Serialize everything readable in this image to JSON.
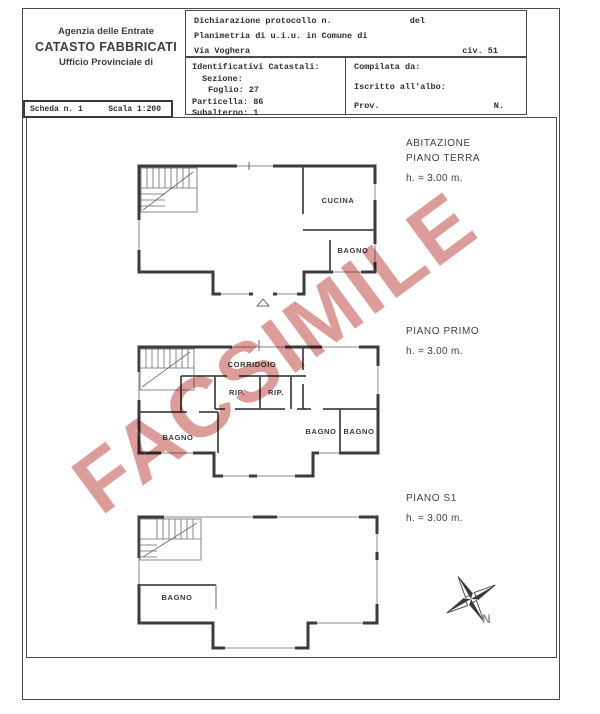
{
  "header": {
    "agency": {
      "line1": "Agenzia delle Entrate",
      "line2": "CATASTO FABBRICATI",
      "line3": "Ufficio Provinciale di"
    },
    "scheda": {
      "left": "Scheda n. 1",
      "right": "Scala 1:200"
    },
    "declaration": {
      "protocol": "Dichiarazione protocollo n.",
      "del": "del",
      "planimetria": "Planimetria di u.i.u. in Comune di",
      "street": "Via Voghera",
      "civic": "civ. 51"
    },
    "catastali": {
      "title": "Identificativi Catastali:",
      "sezione": "Sezione:",
      "foglio": "Foglio: 27",
      "particella": "Particella: 86",
      "subalterno": "Subalterno: 1"
    },
    "compilata": {
      "line1": "Compilata da:",
      "line2": "Iscritto all'albo:",
      "prov": "Prov.",
      "n": "N."
    }
  },
  "floors": [
    {
      "title": "ABITAZIONE",
      "name": "PIANO TERRA",
      "height": "h. = 3.00 m.",
      "rooms": [
        {
          "label": "CUCINA"
        },
        {
          "label": "BAGNO"
        }
      ]
    },
    {
      "name": "PIANO PRIMO",
      "height": "h. = 3.00 m.",
      "rooms": [
        {
          "label": "CORRIDOIO"
        },
        {
          "label": "RIP."
        },
        {
          "label": "RIP."
        },
        {
          "label": "BAGNO"
        },
        {
          "label": "BAGNO"
        },
        {
          "label": "BAGNO"
        }
      ]
    },
    {
      "name": "PIANO S1",
      "height": "h. = 3.00 m.",
      "rooms": [
        {
          "label": "BAGNO"
        }
      ]
    }
  ],
  "watermark": {
    "text": "FACSIMILE",
    "color": "#d8908c"
  },
  "compass": {
    "label": "N"
  }
}
